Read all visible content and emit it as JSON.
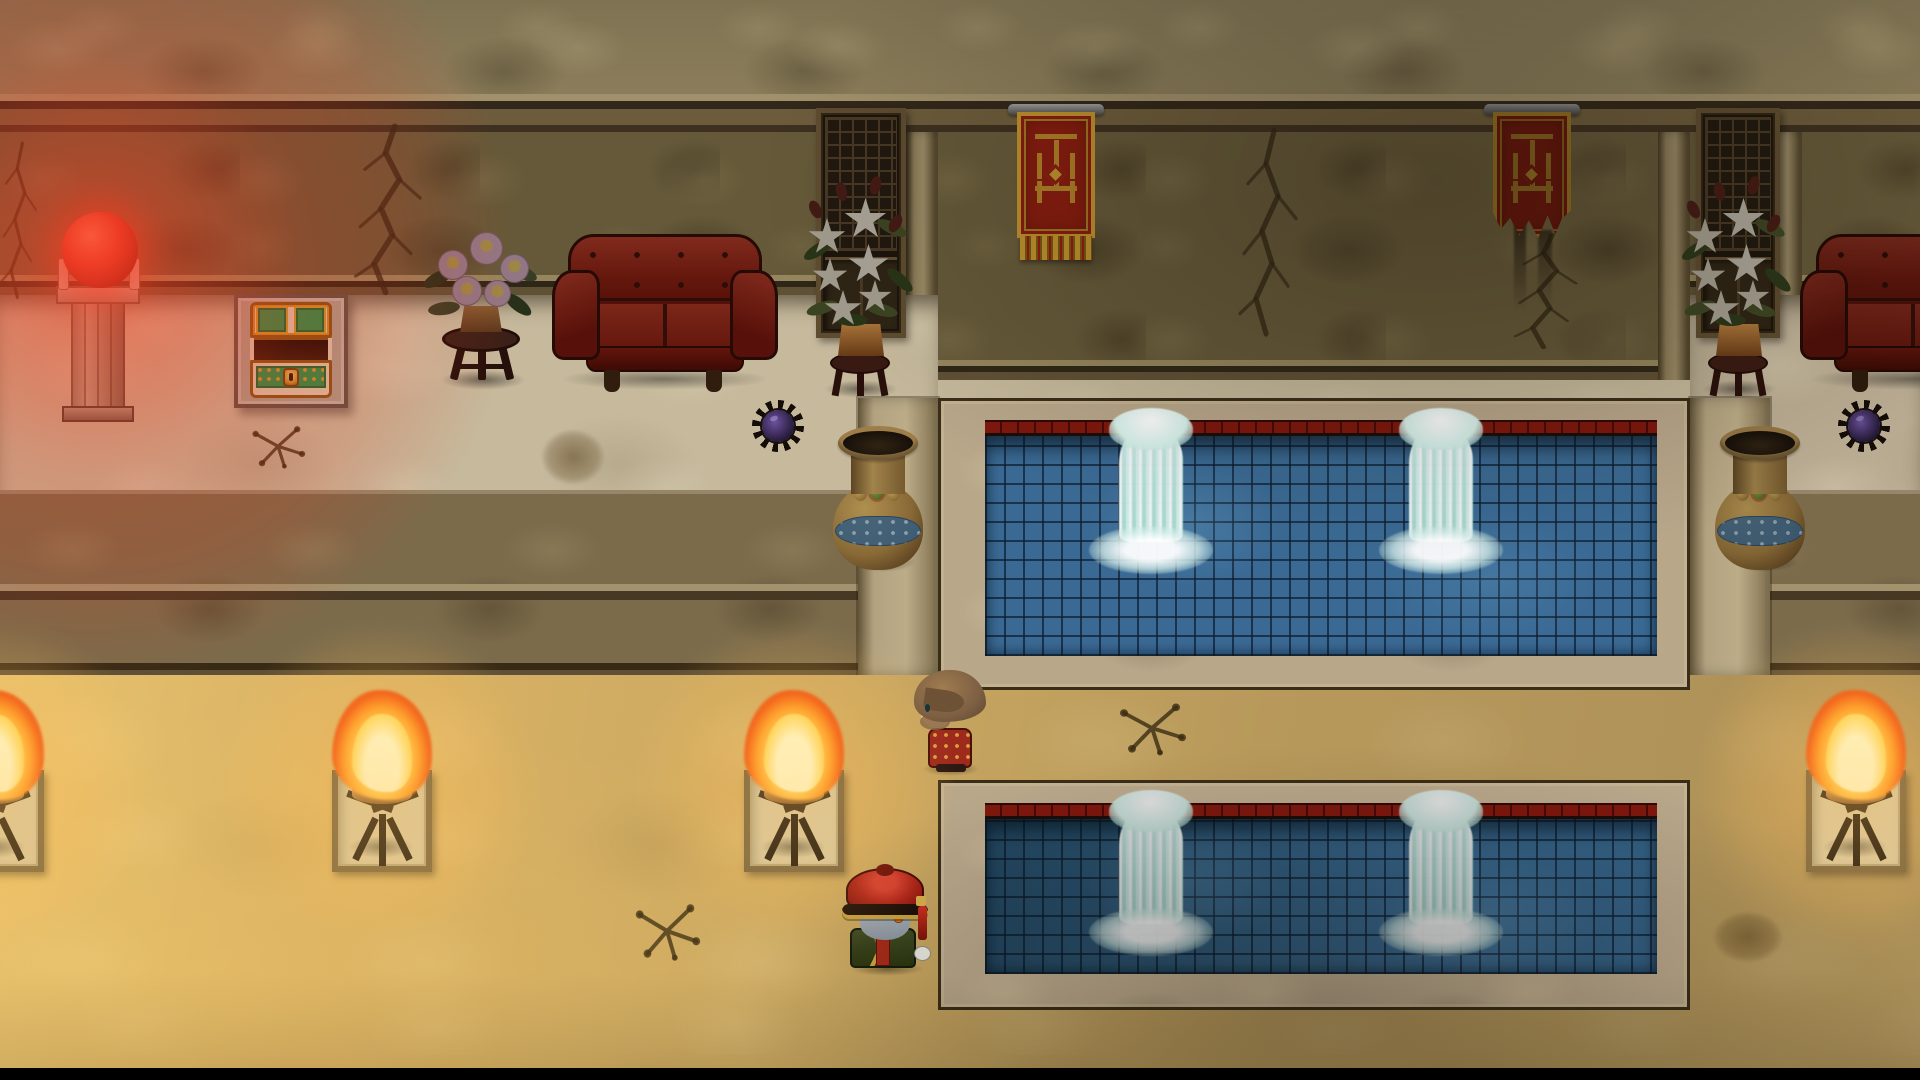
{
  "scene": {
    "viewport": {
      "width": 1920,
      "height": 1080
    },
    "palette": {
      "red_glow": "#e62d14",
      "orb_red": "#e03426",
      "torch_flame_core": "#fff8c8",
      "torch_flame": "#ffd95e",
      "torch_flame_edge": "#f25a14",
      "gold_floor": "#d9b368",
      "pale_floor": "#c6b99c",
      "upper_wall": "#655939",
      "cornice": "#8d7f5c",
      "step_shadow": "#70614a",
      "water_blue": "#3a6a94",
      "water_dark": "#336084",
      "pool_rim_red": "#7e170c",
      "pool_frame": "#b9a78a",
      "fountain_white": "#eefcfa",
      "couch_red": "#8e2214",
      "banner_red": "#8e1d10",
      "banner_gold": "#c9992f",
      "chest_cream": "#e3d6b8",
      "chest_green": "#27984e",
      "chest_gold": "#d89020",
      "lily_white": "#d8d0be",
      "leaf_green": "#4e5a2e",
      "pink_flower": "#d4a9be",
      "vase_gold": "#b08a4a",
      "vase_blue": "#3e6d96",
      "spike_purple": "#5a4080",
      "hat_red": "#b02418",
      "robe_green": "#3e4a22",
      "npc_outfit_red": "#9e2a1c",
      "npc_hair_brown": "#7d5f42",
      "jiangshi_skin": "#9aa4b0",
      "letterbox_black": "#000000"
    },
    "entities": [
      {
        "type": "wall-crack",
        "name": "wall-crack-far-left",
        "x": -10,
        "y": 140,
        "w": 62,
        "h": 170,
        "interactable": false
      },
      {
        "type": "wall-crack",
        "name": "wall-crack-left",
        "x": 335,
        "y": 122,
        "w": 115,
        "h": 185,
        "interactable": false
      },
      {
        "type": "wall-crack",
        "name": "wall-crack-center",
        "x": 1222,
        "y": 126,
        "w": 100,
        "h": 225,
        "interactable": false
      },
      {
        "type": "wall-crack",
        "name": "wall-crack-right",
        "x": 1496,
        "y": 232,
        "w": 108,
        "h": 125,
        "interactable": false
      },
      {
        "type": "lattice-window",
        "name": "lattice-window-left",
        "x": 816,
        "y": 108,
        "w": 90,
        "h": 230,
        "dim": 0.85,
        "interactable": false
      },
      {
        "type": "lattice-window",
        "name": "lattice-window-right",
        "x": 1696,
        "y": 108,
        "w": 84,
        "h": 230,
        "dim": 0.85,
        "interactable": false
      },
      {
        "type": "banner",
        "name": "wall-banner-left",
        "x": 1014,
        "y": 104,
        "w": 84,
        "h": 166,
        "variant": "fringed",
        "dim": 0.95,
        "interactable": false
      },
      {
        "type": "banner",
        "name": "wall-banner-right",
        "x": 1490,
        "y": 104,
        "w": 84,
        "h": 152,
        "variant": "tattered",
        "dim": 0.82,
        "interactable": false
      },
      {
        "type": "floor-crack",
        "name": "floor-crack-upper-left",
        "x": 246,
        "y": 420,
        "w": 64,
        "h": 54,
        "interactable": false
      },
      {
        "type": "floor-crack",
        "name": "floor-crack-lower-left",
        "x": 628,
        "y": 896,
        "w": 78,
        "h": 72,
        "interactable": false
      },
      {
        "type": "floor-crack",
        "name": "floor-crack-walkway",
        "x": 1112,
        "y": 696,
        "w": 80,
        "h": 66,
        "interactable": false
      },
      {
        "type": "dirt-spot",
        "name": "dirt-spot-left",
        "x": 542,
        "y": 430,
        "w": 62,
        "h": 54,
        "interactable": false
      },
      {
        "type": "dirt-spot",
        "name": "dirt-spot-lower-right",
        "x": 1714,
        "y": 912,
        "w": 68,
        "h": 50,
        "interactable": false
      },
      {
        "type": "orb-pedestal",
        "name": "glowing-orb-pedestal",
        "x": 50,
        "y": 198,
        "w": 96,
        "h": 228,
        "interactable": true
      },
      {
        "type": "treasure-chest",
        "name": "treasure-chest",
        "x": 234,
        "y": 294,
        "w": 114,
        "h": 114,
        "dim": 0.95,
        "interactable": true
      },
      {
        "type": "flower-table",
        "name": "pink-flower-table",
        "x": 414,
        "y": 214,
        "w": 134,
        "h": 186,
        "interactable": false
      },
      {
        "type": "couch",
        "name": "couch-left",
        "x": 552,
        "y": 234,
        "w": 226,
        "h": 160,
        "dim": 0.8,
        "interactable": false
      },
      {
        "type": "lily-plant",
        "name": "lily-plant-left",
        "x": 804,
        "y": 156,
        "w": 112,
        "h": 244,
        "dim": 0.75,
        "interactable": false
      },
      {
        "type": "lily-plant",
        "name": "lily-plant-right",
        "x": 1682,
        "y": 156,
        "w": 112,
        "h": 244,
        "dim": 0.78,
        "interactable": false
      },
      {
        "type": "couch",
        "name": "couch-right",
        "x": 1800,
        "y": 234,
        "w": 226,
        "h": 160,
        "dim": 0.72,
        "interactable": false
      },
      {
        "type": "vase",
        "name": "vase-left",
        "x": 830,
        "y": 420,
        "w": 96,
        "h": 158,
        "dim": 0.85,
        "interactable": false
      },
      {
        "type": "vase",
        "name": "vase-right",
        "x": 1712,
        "y": 420,
        "w": 96,
        "h": 158,
        "dim": 0.8,
        "interactable": false
      },
      {
        "type": "spike-ball",
        "name": "spike-ball-left",
        "x": 752,
        "y": 400,
        "w": 52,
        "h": 52,
        "dim": 0.9,
        "interactable": false
      },
      {
        "type": "spike-ball",
        "name": "spike-ball-right",
        "x": 1838,
        "y": 400,
        "w": 52,
        "h": 52,
        "dim": 0.85,
        "interactable": false
      },
      {
        "type": "torch",
        "name": "torch-1",
        "x": -62,
        "y": 698,
        "w": 112,
        "h": 180,
        "interactable": false
      },
      {
        "type": "torch",
        "name": "torch-2",
        "x": 326,
        "y": 698,
        "w": 112,
        "h": 180,
        "interactable": false
      },
      {
        "type": "torch",
        "name": "torch-3",
        "x": 738,
        "y": 698,
        "w": 112,
        "h": 180,
        "interactable": false
      },
      {
        "type": "torch",
        "name": "torch-4",
        "x": 1800,
        "y": 698,
        "w": 112,
        "h": 180,
        "interactable": false
      },
      {
        "type": "fountain",
        "name": "fountain-upper-left",
        "x": 1095,
        "y": 410,
        "w": 112,
        "h": 172,
        "interactable": false
      },
      {
        "type": "fountain",
        "name": "fountain-upper-right",
        "x": 1385,
        "y": 410,
        "w": 112,
        "h": 172,
        "interactable": false
      },
      {
        "type": "fountain",
        "name": "fountain-lower-left",
        "x": 1095,
        "y": 792,
        "w": 112,
        "h": 172,
        "dim": 0.88,
        "interactable": false
      },
      {
        "type": "fountain",
        "name": "fountain-lower-right",
        "x": 1385,
        "y": 792,
        "w": 112,
        "h": 172,
        "dim": 0.88,
        "interactable": false
      },
      {
        "type": "npc",
        "name": "npc-man-red-robe",
        "x": 912,
        "y": 670,
        "w": 78,
        "h": 108,
        "facing": "left",
        "interactable": true
      },
      {
        "type": "jiangshi",
        "name": "jiangshi-player-character",
        "x": 838,
        "y": 866,
        "w": 98,
        "h": 110,
        "facing": "right",
        "interactable": true
      }
    ]
  }
}
